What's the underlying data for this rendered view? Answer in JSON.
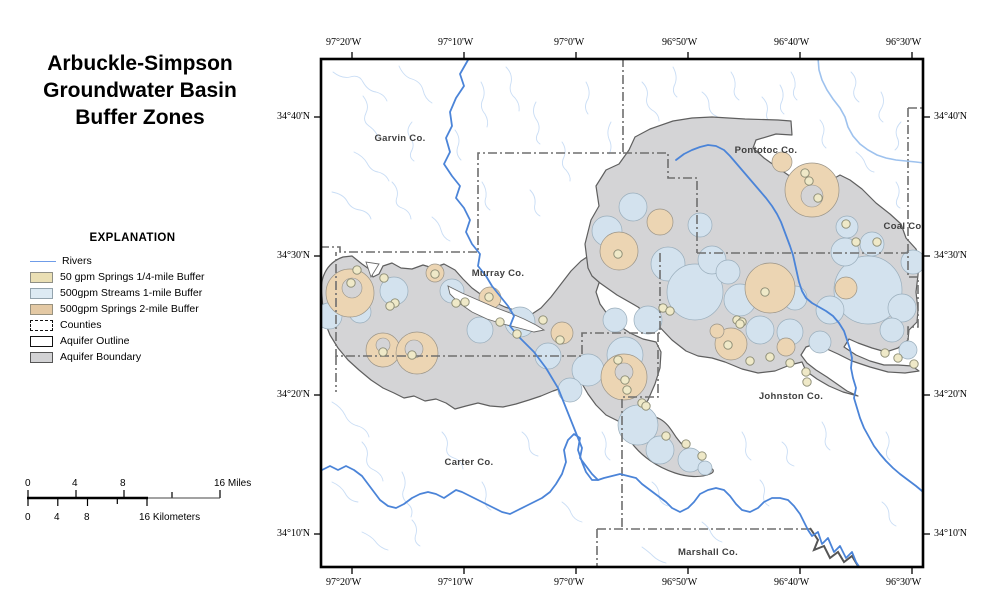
{
  "title": {
    "line1": "Arbuckle-Simpson",
    "line2": "Groundwater Basin",
    "line3": "Buffer Zones"
  },
  "legend": {
    "heading": "EXPLANATION",
    "items": [
      {
        "label": "Rivers",
        "swatch_stroke": "#6f9ce8",
        "type": "line"
      },
      {
        "label": "50 gpm Springs 1/4-mile Buffer",
        "swatch_fill": "#eadfb4",
        "type": "fill"
      },
      {
        "label": "500gpm Streams 1-mile Buffer",
        "swatch_fill": "#ddeaf3",
        "type": "fill"
      },
      {
        "label": "500gpm Springs 2-mile Buffer",
        "swatch_fill": "#e4c9a4",
        "type": "fill"
      },
      {
        "label": "Counties",
        "swatch_fill": "#ffffff",
        "type": "dashed-outline"
      },
      {
        "label": "Aquifer Outline",
        "swatch_fill": "#ffffff",
        "type": "outline"
      },
      {
        "label": "Aquifer Boundary",
        "swatch_fill": "#d2d2d4",
        "type": "fill"
      }
    ]
  },
  "scalebar": {
    "miles": {
      "t0": "0",
      "t4": "4",
      "t8": "8",
      "end": "16 Miles"
    },
    "km": {
      "t0": "0",
      "t4": "4",
      "t8": "8",
      "end": "16 Kilometers"
    }
  },
  "map": {
    "lon": [
      "97°20'W",
      "97°10'W",
      "97°0'W",
      "96°50'W",
      "96°40'W",
      "96°30'W"
    ],
    "lat": [
      "34°40'N",
      "34°30'N",
      "34°20'N",
      "34°10'N"
    ],
    "counties": [
      {
        "name": "Garvin Co."
      },
      {
        "name": "Pontotoc Co."
      },
      {
        "name": "Coal Co."
      },
      {
        "name": "Murray Co."
      },
      {
        "name": "Johnston Co."
      },
      {
        "name": "Carter Co."
      },
      {
        "name": "Marshall Co."
      }
    ],
    "colors": {
      "aquifer_fill": "#d4d4d6",
      "aquifer_outline": "#5f5f5f",
      "springs_quarter_mile_buffer": "#efe9c8",
      "streams_one_mile_buffer": "#d3e2ee",
      "springs_two_mile_buffer": "#ecd5b3",
      "river": "#4b84d8",
      "minor_stream": "#c9ddf5",
      "county_line": "#6e6e6e",
      "map_border": "#000000"
    }
  }
}
